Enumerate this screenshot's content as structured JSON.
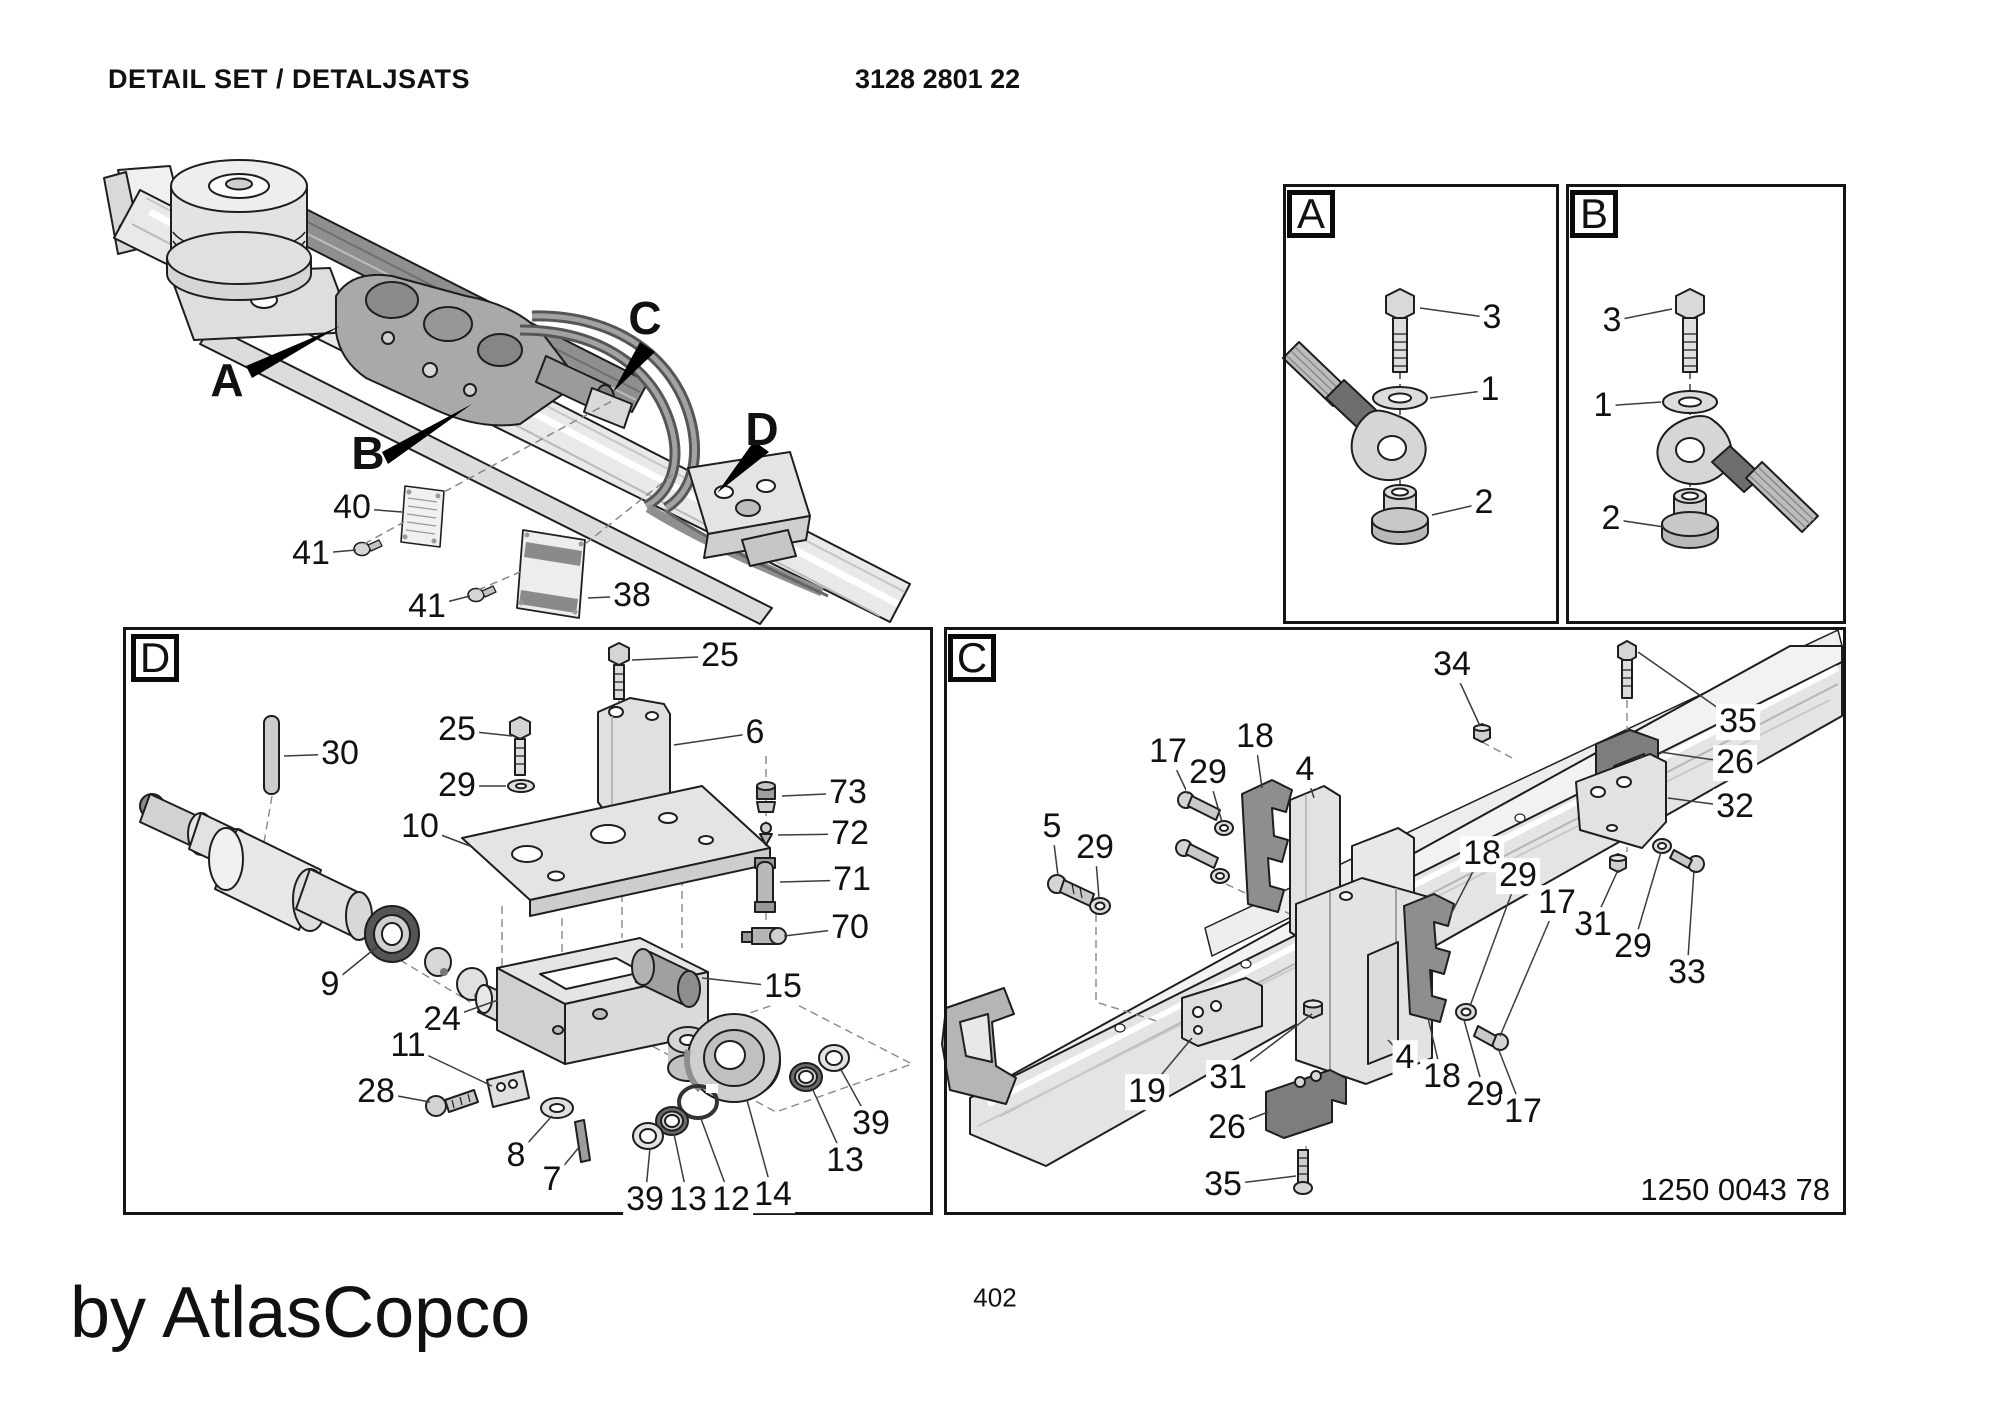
{
  "header": {
    "title": "DETAIL SET / DETALJSATS",
    "part_number": "3128 2801 22"
  },
  "footer": {
    "page_number": "402",
    "byline": "by AtlasCopco"
  },
  "panels": {
    "a": {
      "letter": "A"
    },
    "b": {
      "letter": "B"
    },
    "c": {
      "letter": "C",
      "ref_number": "1250 0043 78"
    },
    "d": {
      "letter": "D"
    }
  },
  "main_view": {
    "sign_plate_text": "Atlas Copco",
    "view_letters": [
      {
        "label": "A",
        "x": 227,
        "y": 380
      },
      {
        "label": "B",
        "x": 368,
        "y": 453
      },
      {
        "label": "C",
        "x": 645,
        "y": 318
      },
      {
        "label": "D",
        "x": 762,
        "y": 429
      }
    ]
  },
  "callout_groups": {
    "main_view": {
      "items": [
        {
          "label": "40",
          "x": 352,
          "y": 508,
          "tx": 402,
          "ty": 512
        },
        {
          "label": "41",
          "x": 311,
          "y": 554,
          "tx": 356,
          "ty": 550
        },
        {
          "label": "41",
          "x": 427,
          "y": 607,
          "tx": 470,
          "ty": 596
        },
        {
          "label": "38",
          "x": 632,
          "y": 596,
          "tx": 588,
          "ty": 598
        }
      ]
    },
    "panel_a": {
      "items": [
        {
          "label": "3",
          "x": 1492,
          "y": 318,
          "tx": 1420,
          "ty": 308
        },
        {
          "label": "1",
          "x": 1490,
          "y": 390,
          "tx": 1430,
          "ty": 398
        },
        {
          "label": "2",
          "x": 1484,
          "y": 503,
          "tx": 1432,
          "ty": 515
        }
      ]
    },
    "panel_b": {
      "items": [
        {
          "label": "3",
          "x": 1612,
          "y": 321,
          "tx": 1672,
          "ty": 309
        },
        {
          "label": "1",
          "x": 1603,
          "y": 406,
          "tx": 1661,
          "ty": 402
        },
        {
          "label": "2",
          "x": 1611,
          "y": 519,
          "tx": 1664,
          "ty": 527
        }
      ]
    },
    "panel_d": {
      "items": [
        {
          "label": "30",
          "x": 340,
          "y": 754,
          "tx": 284,
          "ty": 756
        },
        {
          "label": "25",
          "x": 457,
          "y": 730,
          "tx": 512,
          "ty": 736
        },
        {
          "label": "29",
          "x": 457,
          "y": 786,
          "tx": 506,
          "ty": 786
        },
        {
          "label": "10",
          "x": 420,
          "y": 827,
          "tx": 470,
          "ty": 846
        },
        {
          "label": "25",
          "x": 720,
          "y": 656,
          "tx": 632,
          "ty": 660
        },
        {
          "label": "6",
          "x": 755,
          "y": 733,
          "tx": 674,
          "ty": 745
        },
        {
          "label": "73",
          "x": 848,
          "y": 793,
          "tx": 782,
          "ty": 796
        },
        {
          "label": "72",
          "x": 850,
          "y": 834,
          "tx": 778,
          "ty": 835
        },
        {
          "label": "71",
          "x": 852,
          "y": 880,
          "tx": 780,
          "ty": 882
        },
        {
          "label": "70",
          "x": 850,
          "y": 928,
          "tx": 784,
          "ty": 936
        },
        {
          "label": "9",
          "x": 330,
          "y": 985,
          "tx": 378,
          "ty": 946
        },
        {
          "label": "24",
          "x": 442,
          "y": 1020,
          "tx": 498,
          "ty": 1000
        },
        {
          "label": "11",
          "x": 408,
          "y": 1046,
          "tx": 492,
          "ty": 1086
        },
        {
          "label": "28",
          "x": 376,
          "y": 1092,
          "tx": 430,
          "ty": 1102
        },
        {
          "label": "8",
          "x": 516,
          "y": 1156,
          "tx": 552,
          "ty": 1116
        },
        {
          "label": "7",
          "x": 552,
          "y": 1180,
          "tx": 580,
          "ty": 1146
        },
        {
          "label": "15",
          "x": 783,
          "y": 987,
          "tx": 702,
          "ty": 978
        },
        {
          "label": "39",
          "x": 645,
          "y": 1200,
          "tx": 650,
          "ty": 1148
        },
        {
          "label": "13",
          "x": 688,
          "y": 1200,
          "tx": 674,
          "ty": 1134
        },
        {
          "label": "12",
          "x": 731,
          "y": 1200,
          "tx": 700,
          "ty": 1116
        },
        {
          "label": "14",
          "x": 773,
          "y": 1195,
          "tx": 747,
          "ty": 1100
        },
        {
          "label": "13",
          "x": 845,
          "y": 1161,
          "tx": 812,
          "ty": 1088
        },
        {
          "label": "39",
          "x": 871,
          "y": 1124,
          "tx": 840,
          "ty": 1068
        }
      ]
    },
    "panel_c": {
      "items": [
        {
          "label": "17",
          "x": 1168,
          "y": 752,
          "tx": 1188,
          "ty": 794
        },
        {
          "label": "29",
          "x": 1208,
          "y": 773,
          "tx": 1222,
          "ty": 822
        },
        {
          "label": "18",
          "x": 1255,
          "y": 737,
          "tx": 1262,
          "ty": 788
        },
        {
          "label": "4",
          "x": 1305,
          "y": 770,
          "tx": 1314,
          "ty": 798
        },
        {
          "label": "5",
          "x": 1052,
          "y": 827,
          "tx": 1058,
          "ty": 876
        },
        {
          "label": "29",
          "x": 1095,
          "y": 848,
          "tx": 1099,
          "ty": 898
        },
        {
          "label": "34",
          "x": 1452,
          "y": 665,
          "tx": 1480,
          "ty": 726
        },
        {
          "label": "35",
          "x": 1738,
          "y": 722,
          "tx": 1638,
          "ty": 652
        },
        {
          "label": "26",
          "x": 1735,
          "y": 763,
          "tx": 1660,
          "ty": 752
        },
        {
          "label": "32",
          "x": 1735,
          "y": 807,
          "tx": 1668,
          "ty": 798
        },
        {
          "label": "31",
          "x": 1593,
          "y": 925,
          "tx": 1618,
          "ty": 870
        },
        {
          "label": "29",
          "x": 1633,
          "y": 947,
          "tx": 1661,
          "ty": 852
        },
        {
          "label": "33",
          "x": 1687,
          "y": 973,
          "tx": 1694,
          "ty": 870
        },
        {
          "label": "18",
          "x": 1482,
          "y": 854,
          "tx": 1450,
          "ty": 916
        },
        {
          "label": "29",
          "x": 1518,
          "y": 876,
          "tx": 1470,
          "ty": 1006
        },
        {
          "label": "17",
          "x": 1557,
          "y": 903,
          "tx": 1500,
          "ty": 1036
        },
        {
          "label": "19",
          "x": 1147,
          "y": 1092,
          "tx": 1192,
          "ty": 1038
        },
        {
          "label": "31",
          "x": 1228,
          "y": 1078,
          "tx": 1312,
          "ty": 1014
        },
        {
          "label": "26",
          "x": 1227,
          "y": 1128,
          "tx": 1268,
          "ty": 1112
        },
        {
          "label": "35",
          "x": 1223,
          "y": 1185,
          "tx": 1296,
          "ty": 1176
        },
        {
          "label": "4",
          "x": 1405,
          "y": 1058,
          "tx": 1388,
          "ty": 1040
        },
        {
          "label": "18",
          "x": 1442,
          "y": 1077,
          "tx": 1428,
          "ty": 1018
        },
        {
          "label": "29",
          "x": 1485,
          "y": 1095,
          "tx": 1464,
          "ty": 1020
        },
        {
          "label": "17",
          "x": 1523,
          "y": 1112,
          "tx": 1498,
          "ty": 1048
        }
      ]
    }
  }
}
